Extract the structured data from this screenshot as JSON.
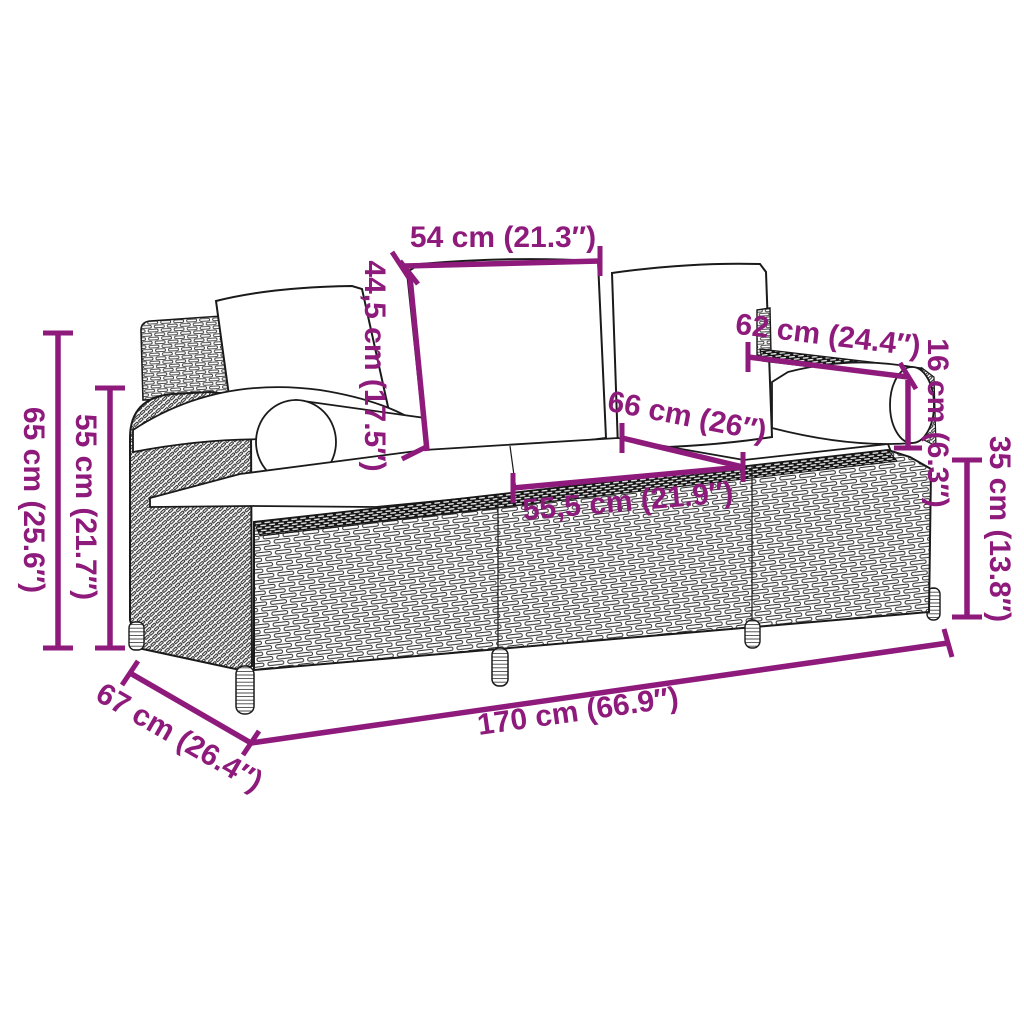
{
  "diagram": {
    "accent_color": "#8e1a7c",
    "line_color": "#1a1a1a",
    "dimensions": [
      {
        "name": "middle-back-cushion-width",
        "label": "54 cm (21.3″)"
      },
      {
        "name": "back-cushion-height",
        "label": "44,5 cm (17.5″)"
      },
      {
        "name": "armrest-bolster-length",
        "label": "62 cm (24.4″)"
      },
      {
        "name": "bolster-diameter",
        "label": "16 cm (6.3″)"
      },
      {
        "name": "seat-depth",
        "label": "66 cm (26″)"
      },
      {
        "name": "seat-cushion-width",
        "label": "55,5 cm (21.9″)"
      },
      {
        "name": "seat-height",
        "label": "35 cm (13.8″)"
      },
      {
        "name": "overall-height",
        "label": "65 cm (25.6″)"
      },
      {
        "name": "armrest-height",
        "label": "55 cm (21.7″)"
      },
      {
        "name": "overall-depth",
        "label": "67 cm (26.4″)"
      },
      {
        "name": "overall-width",
        "label": "170 cm (66.9″)"
      }
    ]
  }
}
